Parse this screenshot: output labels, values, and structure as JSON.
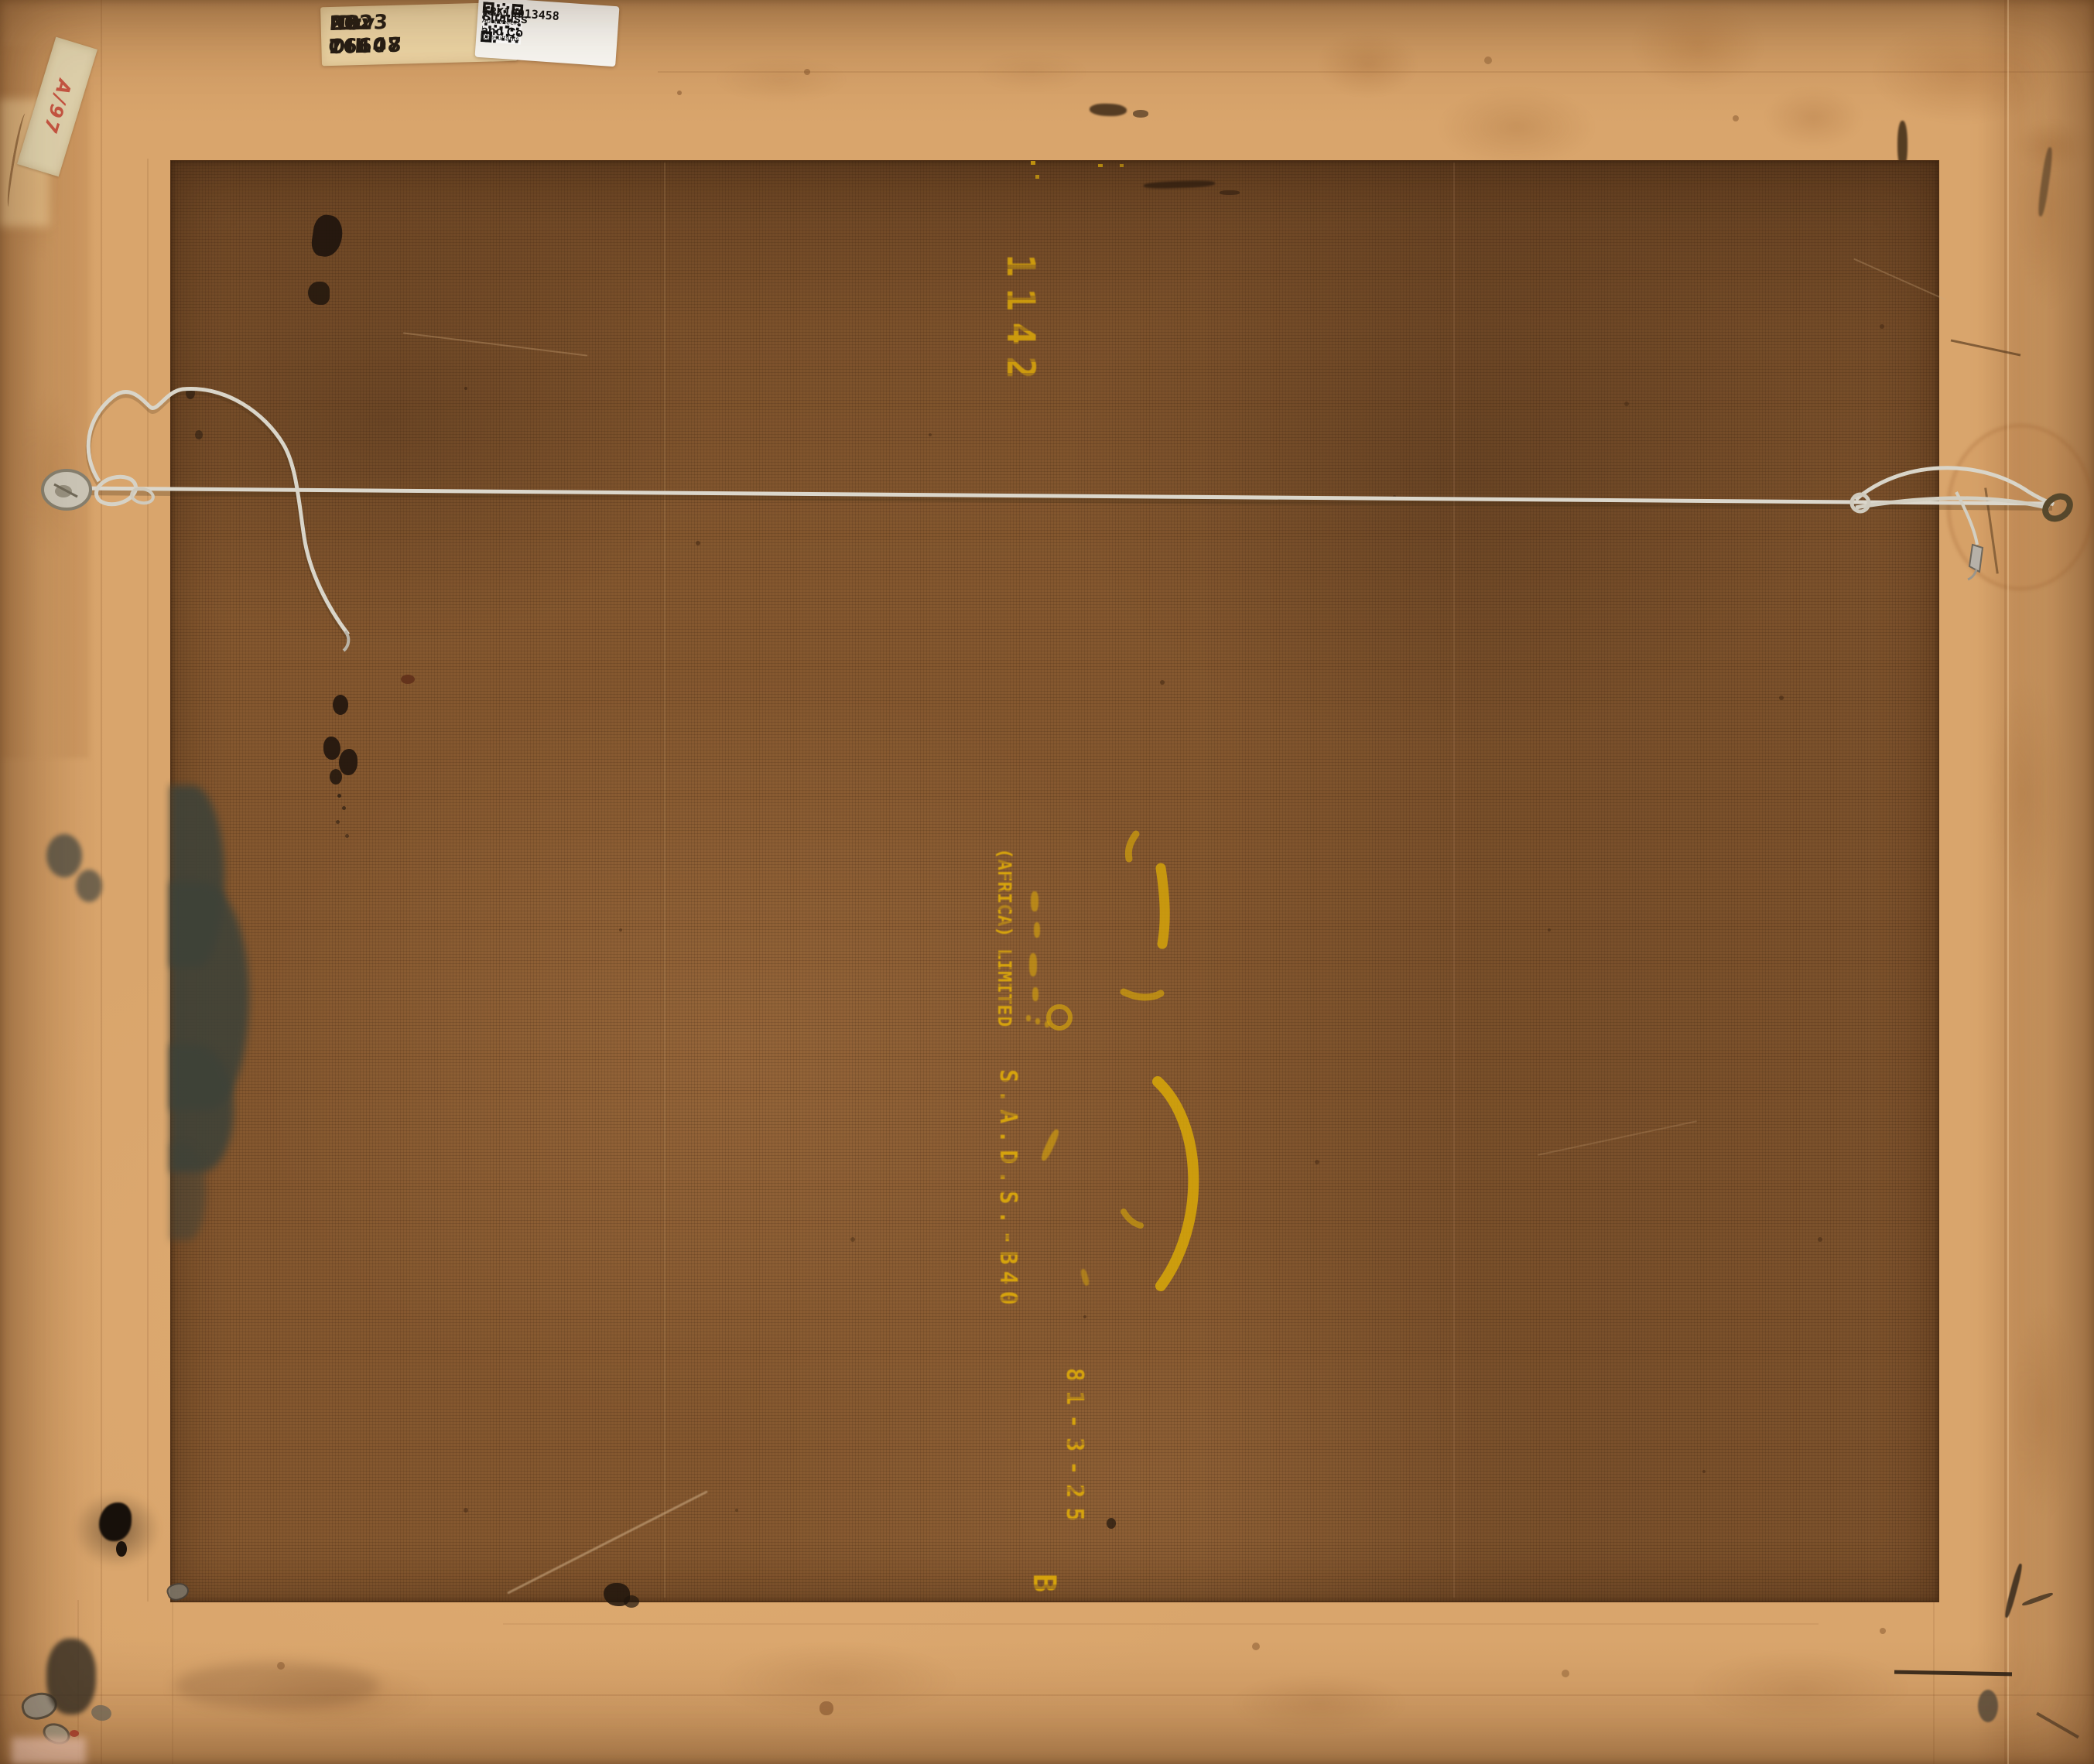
{
  "labels": {
    "inventory": {
      "line1_left": "PR: 16607",
      "line1_right": "Nov OIL",
      "line2_left": "ID: 76148",
      "line2_right": "2023"
    },
    "tracking": {
      "code": "TRK10013458",
      "company": "Strauss and Co",
      "tagline": "Fine Art Auctioneers | Consultants"
    },
    "tape_note": {
      "text": "A/97"
    }
  },
  "stencils": {
    "top_code": "1142",
    "maker_line": "(AFRICA) LIMITED",
    "product_code": "S.A.D.S.-B40",
    "date_code": "81-3-25",
    "bottom_letter": "B"
  },
  "colors": {
    "canvas_brown": "#85582f",
    "backing_tan": "#d9a56c",
    "stencil_yellow": "#e2ae08",
    "wire_white": "#dcd8cd",
    "note_red": "#c03b2d"
  }
}
